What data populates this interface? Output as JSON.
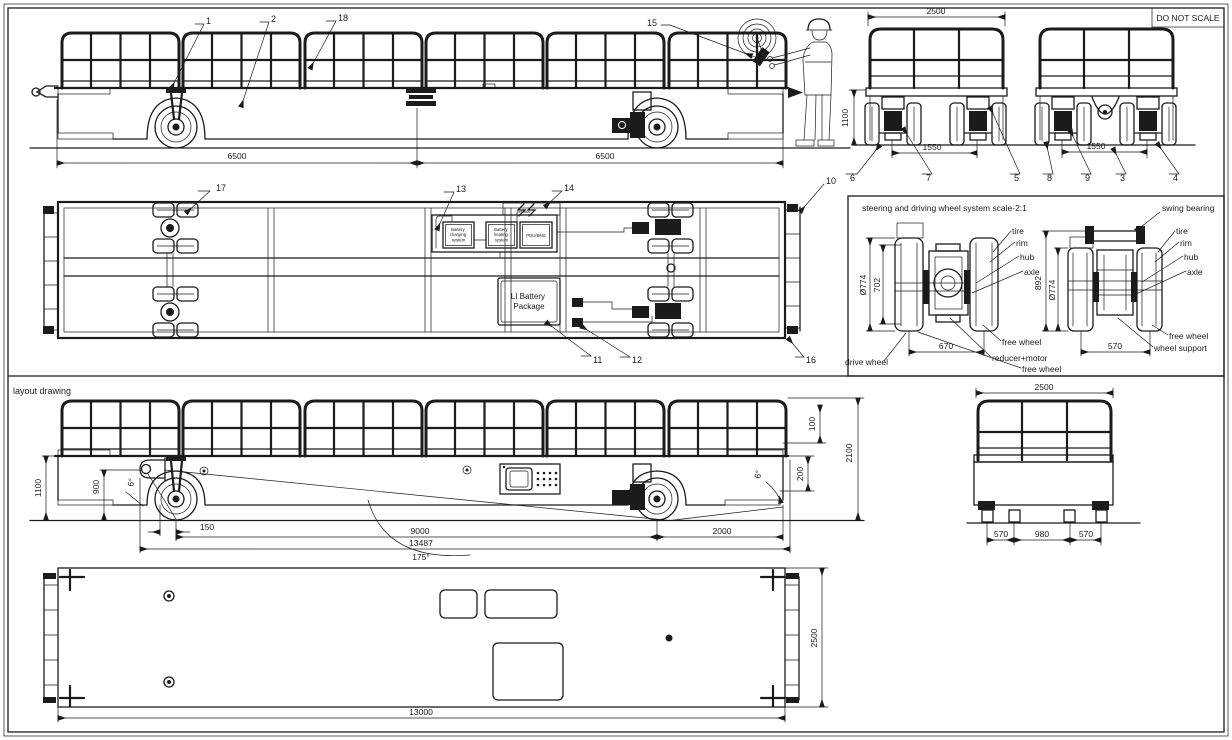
{
  "frame": {
    "do_not_scale": "DO NOT SCALE"
  },
  "sections": {
    "layout_label": "layout drawing",
    "wheel_detail_title": "steering and driving wheel system  scale-2:1"
  },
  "callouts": {
    "n1": "1",
    "n2": "2",
    "n3": "3",
    "n4": "4",
    "n5": "5",
    "n6": "6",
    "n7": "7",
    "n8": "8",
    "n9": "9",
    "n10": "10",
    "n11": "11",
    "n12": "12",
    "n13": "13",
    "n14": "14",
    "n15": "15",
    "n16": "16",
    "n17": "17",
    "n18": "18"
  },
  "side_view": {
    "dim_front": "6500",
    "dim_rear": "6500"
  },
  "end_view": {
    "dim_width": "2500",
    "dim_height": "1100",
    "dim_track_fixed": "1550",
    "dim_track_steer": "1550"
  },
  "plan_view": {
    "charging_lines": [
      "Battery",
      "charging",
      "system"
    ],
    "heating_lines": [
      "Battery",
      "heating",
      "system"
    ],
    "pdu": "PDU/BMS",
    "battery_lines": [
      "LI Battery",
      "Package"
    ]
  },
  "wheel_detail": {
    "drive": {
      "dia": "Ø774",
      "rim_dia": "702",
      "track": "670"
    },
    "steer": {
      "height": "892",
      "dia": "Ø774",
      "track": "570"
    },
    "labels": {
      "tire": "tire",
      "rim": "rim",
      "hub": "hub",
      "axle": "axle",
      "free_wheel": "free wheel",
      "drive_wheel": "drive wheel",
      "reducer_motor": "reducer+motor",
      "wheel_support": "wheel support",
      "swing_bearing": "swing bearing"
    }
  },
  "layout_view": {
    "dim_height": "1100",
    "dim_hook": "900",
    "angle_front": "6°",
    "angle_rear": "6°",
    "dim_offset": "150",
    "dim_wheelbase": "9000",
    "dim_overall": "13487",
    "dim_ramp_angle": "175°",
    "dim_overhang": "2000",
    "dim_rail": "100",
    "dim_step": "200",
    "dim_total_height": "2100",
    "end": {
      "dim_width": "2500",
      "dim_a": "570",
      "dim_b": "980",
      "dim_c": "570"
    },
    "plan": {
      "dim_length": "13000",
      "dim_width": "2500"
    }
  }
}
